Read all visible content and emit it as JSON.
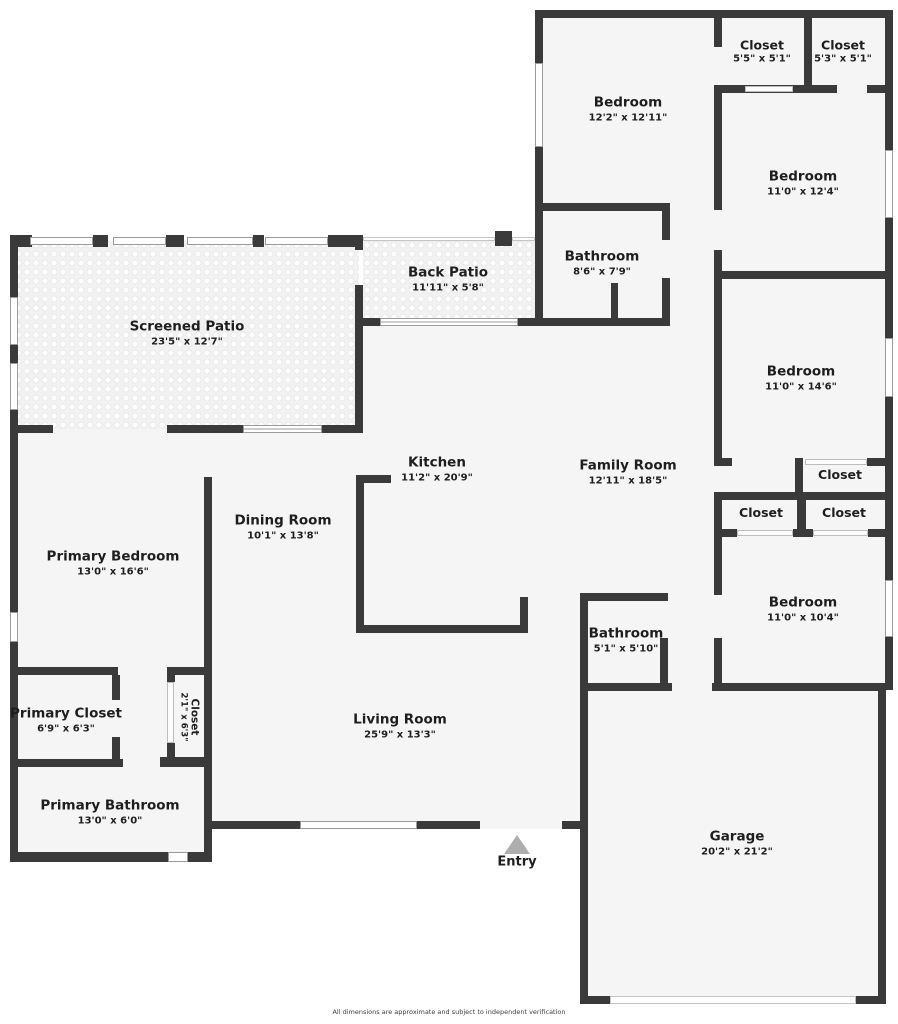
{
  "rooms": [
    {
      "id": "bedroom-top",
      "name": "Bedroom",
      "dims": "12'2\" x 12'11\""
    },
    {
      "id": "closet-top-1",
      "name": "Closet",
      "dims": "5'5\" x 5'1\""
    },
    {
      "id": "closet-top-2",
      "name": "Closet",
      "dims": "5'3\" x 5'1\""
    },
    {
      "id": "bedroom-right-1",
      "name": "Bedroom",
      "dims": "11'0\" x 12'4\""
    },
    {
      "id": "bathroom-main",
      "name": "Bathroom",
      "dims": "8'6\" x 7'9\""
    },
    {
      "id": "back-patio",
      "name": "Back Patio",
      "dims": "11'11\" x 5'8\""
    },
    {
      "id": "screened-patio",
      "name": "Screened Patio",
      "dims": "23'5\" x 12'7\""
    },
    {
      "id": "bedroom-right-2",
      "name": "Bedroom",
      "dims": "11'0\" x 14'6\""
    },
    {
      "id": "closet-mid-top",
      "name": "Closet"
    },
    {
      "id": "closet-mid-left",
      "name": "Closet"
    },
    {
      "id": "closet-mid-right",
      "name": "Closet"
    },
    {
      "id": "kitchen",
      "name": "Kitchen",
      "dims": "11'2\" x 20'9\""
    },
    {
      "id": "family-room",
      "name": "Family Room",
      "dims": "12'11\" x 18'5\""
    },
    {
      "id": "dining-room",
      "name": "Dining Room",
      "dims": "10'1\" x 13'8\""
    },
    {
      "id": "primary-bedroom",
      "name": "Primary Bedroom",
      "dims": "13'0\" x 16'6\""
    },
    {
      "id": "bedroom-right-3",
      "name": "Bedroom",
      "dims": "11'0\" x 10'4\""
    },
    {
      "id": "bathroom-small",
      "name": "Bathroom",
      "dims": "5'1\" x 5'10\""
    },
    {
      "id": "primary-closet",
      "name": "Primary Closet",
      "dims": "6'9\" x 6'3\""
    },
    {
      "id": "closet-linen",
      "name": "Closet",
      "dims": "2'1\" x 6'3\""
    },
    {
      "id": "living-room",
      "name": "Living Room",
      "dims": "25'9\" x 13'3\""
    },
    {
      "id": "primary-bathroom",
      "name": "Primary Bathroom",
      "dims": "13'0\" x 6'0\""
    },
    {
      "id": "garage",
      "name": "Garage",
      "dims": "20'2\" x 21'2\""
    }
  ],
  "entry": {
    "label": "Entry"
  },
  "footer": {
    "disclaimer": "All dimensions are approximate and subject to independent verification"
  },
  "colors": {
    "wall": "#3a3a3a",
    "floor": "#f5f5f5",
    "text": "#1e1e1e",
    "entry_arrow": "#aeaeae"
  }
}
